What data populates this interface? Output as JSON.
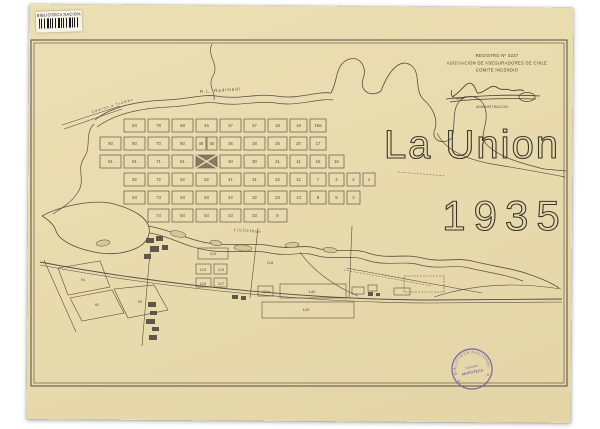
{
  "library_label": {
    "text": "BIBLIOTECA NACIONAL"
  },
  "registro": {
    "line1": "REGISTRO Nº 3237",
    "line2": "ASOCIACION DE ASEGURADORES DE CHILE",
    "line3": "COMITE INCENDIO",
    "signature_caption": "ADMINISTRACION"
  },
  "title": {
    "name": "La Union",
    "year": "1935"
  },
  "round_stamp": {
    "arc_text": "BIBLIOTECA NACIONAL",
    "center1": "Sección",
    "center2": "MAPOTECA",
    "star": "★",
    "color": "#6d52a3"
  },
  "map": {
    "ink": "#5a4f40",
    "sheet": "#e8dbae",
    "dark_fill": "#5f574a",
    "island_fill": "#d5c796",
    "plaza_fill": "#877b66",
    "labels": [
      {
        "t": "R.L. Radimadi",
        "x": 200,
        "y": 93,
        "r": -4,
        "s": 4.4
      },
      {
        "t": "Llollelhue",
        "x": 234,
        "y": 231,
        "r": 4,
        "s": 4.2
      },
      {
        "t": "Camino a Trumao",
        "x": 92,
        "y": 113,
        "r": -17,
        "s": 3.6
      }
    ],
    "grid": {
      "cols": [
        [
          100,
          21
        ],
        [
          124,
          21
        ],
        [
          148,
          21
        ],
        [
          172,
          21
        ],
        [
          196,
          21
        ],
        [
          220,
          21
        ],
        [
          244,
          21
        ],
        [
          268,
          19
        ],
        [
          290,
          17
        ],
        [
          310,
          16
        ],
        [
          329,
          15
        ],
        [
          347,
          13
        ],
        [
          363,
          12
        ]
      ],
      "rows": [
        {
          "y": 119,
          "h": 13,
          "cells": [
            {
              "c": 1,
              "n": "84"
            },
            {
              "c": 2,
              "n": "79"
            },
            {
              "c": 3,
              "n": "58"
            },
            {
              "c": 4,
              "n": "46"
            },
            {
              "c": 5,
              "n": "37"
            },
            {
              "c": 6,
              "n": "27"
            },
            {
              "c": 7,
              "n": "18"
            },
            {
              "c": 8,
              "n": "19"
            },
            {
              "c": 9,
              "n": "19a"
            }
          ]
        },
        {
          "y": 137,
          "h": 13,
          "cells": [
            {
              "c": 0,
              "n": "90"
            },
            {
              "c": 1,
              "n": "80"
            },
            {
              "c": 2,
              "n": "70"
            },
            {
              "c": 3,
              "n": "60"
            },
            {
              "x": 196,
              "w": 10,
              "n": "49"
            },
            {
              "x": 207,
              "w": 10,
              "n": "50"
            },
            {
              "c": 5,
              "n": "36"
            },
            {
              "c": 6,
              "n": "28"
            },
            {
              "c": 7,
              "n": "26"
            },
            {
              "c": 8,
              "n": "20"
            },
            {
              "c": 9,
              "n": "17"
            }
          ]
        },
        {
          "y": 155,
          "h": 13,
          "cells": [
            {
              "c": 0,
              "n": "91"
            },
            {
              "c": 1,
              "n": "81"
            },
            {
              "c": 2,
              "n": "71"
            },
            {
              "c": 3,
              "n": "61"
            },
            {
              "c": 4,
              "n": "PLAZA"
            },
            {
              "c": 5,
              "n": "40"
            },
            {
              "c": 6,
              "n": "30"
            },
            {
              "c": 7,
              "n": "21"
            },
            {
              "c": 8,
              "n": "11"
            },
            {
              "c": 9,
              "n": "16"
            },
            {
              "c": 10,
              "n": "15"
            }
          ]
        },
        {
          "y": 173,
          "h": 13,
          "cells": [
            {
              "c": 1,
              "n": "82"
            },
            {
              "c": 2,
              "n": "72"
            },
            {
              "c": 3,
              "n": "62"
            },
            {
              "c": 4,
              "n": "52"
            },
            {
              "c": 5,
              "n": "41"
            },
            {
              "c": 6,
              "n": "31"
            },
            {
              "c": 7,
              "n": "22"
            },
            {
              "c": 8,
              "n": "12"
            },
            {
              "c": 9,
              "n": "7"
            },
            {
              "c": 10,
              "n": "4"
            },
            {
              "c": 11,
              "n": "2"
            },
            {
              "c": 12,
              "n": "1"
            }
          ]
        },
        {
          "y": 191,
          "h": 13,
          "cells": [
            {
              "c": 1,
              "n": "83"
            },
            {
              "c": 2,
              "n": "73"
            },
            {
              "c": 3,
              "n": "63"
            },
            {
              "c": 4,
              "n": "53"
            },
            {
              "c": 5,
              "n": "42"
            },
            {
              "c": 6,
              "n": "32"
            },
            {
              "c": 7,
              "n": "23"
            },
            {
              "c": 8,
              "n": "13"
            },
            {
              "c": 9,
              "n": "8"
            },
            {
              "c": 10,
              "n": "5"
            },
            {
              "c": 11,
              "n": "3"
            }
          ]
        },
        {
          "y": 209,
          "h": 13,
          "cells": [
            {
              "c": 2,
              "n": "74"
            },
            {
              "c": 3,
              "n": "64"
            },
            {
              "c": 4,
              "n": "54"
            },
            {
              "c": 5,
              "n": "43"
            },
            {
              "c": 6,
              "n": "33"
            },
            {
              "c": 7,
              "n": "9"
            }
          ]
        }
      ]
    },
    "fields": [
      {
        "n": "91",
        "x": 83,
        "y": 281,
        "poly": "58,268 100,261 110,287 68,295"
      },
      {
        "n": "92",
        "x": 97,
        "y": 306,
        "poly": "70,298 112,290 124,313 82,321"
      },
      {
        "n": "93",
        "x": 140,
        "y": 303,
        "poly": "114,289 154,285 168,310 128,318"
      },
      {
        "n": "114",
        "x": 213,
        "y": 255
      },
      {
        "n": "113",
        "x": 203,
        "y": 271
      },
      {
        "n": "115",
        "x": 221,
        "y": 271
      },
      {
        "n": "116",
        "x": 203,
        "y": 285
      },
      {
        "n": "117",
        "x": 221,
        "y": 285
      },
      {
        "n": "118",
        "x": 270,
        "y": 264
      },
      {
        "n": "119a",
        "x": 266,
        "y": 293
      },
      {
        "n": "140",
        "x": 312,
        "y": 293
      },
      {
        "n": "120",
        "x": 306,
        "y": 311
      }
    ],
    "paths": [
      {
        "name": "rio-radimadi-north-bank",
        "d": "M 95 120 C 112 106 140 101 166 100 C 190 99 202 94 216 96 C 240 100 256 93 276 96 C 298 100 316 91 331 93 C 338 81 335 66 347 60 C 359 54 368 67 363 79 C 359 91 371 98 381 91 C 390 67 402 58 412 66 C 421 74 414 91 424 100 C 433 108 438 119 435 129 C 430 140 443 146 452 138 C 456 124 451 108 461 100 C 471 92 484 98 486 112 C 488 126 478 136 487 145 C 499 157 520 163 544 169 L 566 171",
        "w": 0.8
      },
      {
        "name": "rio-radimadi-south-bank",
        "d": "M 97 127 C 116 113 144 108 169 107 C 192 106 203 101 217 103 C 240 107 257 100 276 103 C 297 107 317 98 333 100",
        "w": 0.7
      },
      {
        "name": "rio-radimadi-outlet",
        "d": "M 437 133 C 446 152 470 160 492 164 C 516 168 540 172 565 177",
        "w": 0.7
      },
      {
        "name": "creek-north",
        "d": "M 212 44 C 206 56 220 64 213 76 C 207 86 216 92 214 100",
        "w": 0.7
      },
      {
        "name": "creek-west",
        "d": "M 94 124 C 84 134 92 146 84 158 C 76 170 86 180 78 192 C 72 202 62 208 53 214",
        "w": 0.7
      },
      {
        "name": "oxbow-lagoon",
        "d": "M 42 216 C 62 205 96 199 114 204 C 136 210 152 220 149 234 C 146 250 118 257 94 252 C 74 248 59 240 56 231 C 54 224 47 219 42 216",
        "w": 0.8
      },
      {
        "name": "rio-llollelhue-north-bank",
        "d": "M 148 226 C 172 230 188 240 208 243 C 232 247 252 242 272 246 C 292 250 302 244 316 248 C 336 254 352 247 368 253 C 388 260 404 253 422 258 C 442 263 456 257 472 261 C 496 267 512 268 528 274 C 543 279 552 283 559 288",
        "w": 0.8
      },
      {
        "name": "rio-llollelhue-south-bank",
        "d": "M 150 233 C 172 237 186 247 206 250 C 230 254 252 249 270 253 C 290 257 302 251 314 255 C 334 261 352 254 366 260 C 386 267 404 260 420 265 C 440 270 455 264 469 268 C 491 273 507 275 523 281",
        "w": 0.7
      },
      {
        "name": "railway-line-1",
        "d": "M 40 262 C 130 279 230 291 330 297 C 370 299 404 300 432 300 L 562 299",
        "w": 0.9
      },
      {
        "name": "railway-line-2",
        "d": "M 40 265 C 130 282 230 294 330 300 C 368 302 404 303 430 303 L 562 302",
        "w": 0.6
      },
      {
        "name": "road-trumao-1",
        "d": "M 62 125 L 120 106",
        "w": 0.6
      },
      {
        "name": "road-trumao-2",
        "d": "M 64 129 L 122 109",
        "w": 0.6
      },
      {
        "name": "street-south-1",
        "d": "M 258 228 L 250 298",
        "w": 0.6
      },
      {
        "name": "street-south-2",
        "d": "M 352 226 L 349 298",
        "w": 0.6
      },
      {
        "name": "channel-diagonal",
        "d": "M 300 252 C 312 270 334 286 358 296",
        "w": 0.6
      },
      {
        "name": "road-east-1",
        "d": "M 346 268 L 482 293",
        "w": 0.6
      },
      {
        "name": "road-east-2",
        "d": "M 434 297 C 458 289 484 285 512 285 C 530 285 548 287 561 289",
        "w": 0.6
      },
      {
        "name": "field-line-1",
        "d": "M 44 260 L 76 332",
        "w": 0.6
      },
      {
        "name": "field-line-2",
        "d": "M 150 252 L 142 346",
        "w": 0.6
      },
      {
        "name": "micro-text-railway",
        "d": "M 344 270 L 432 286",
        "w": 0.5,
        "dash": "1.6 1.6"
      },
      {
        "name": "micro-text-river",
        "d": "M 398 172 L 446 176",
        "w": 0.5,
        "dash": "1.6 1.6"
      }
    ],
    "islands": [
      [
        178,
        234,
        8,
        3,
        12
      ],
      [
        216,
        243,
        6,
        2.5,
        8
      ],
      [
        243,
        248,
        9,
        3,
        5
      ],
      [
        292,
        245,
        7,
        2.5,
        -4
      ],
      [
        330,
        250,
        7,
        2.5,
        6
      ],
      [
        103,
        243,
        7,
        3,
        -8
      ]
    ],
    "outline_rects": [
      [
        352,
        287,
        12,
        7
      ],
      [
        368,
        285,
        9,
        6
      ],
      [
        394,
        288,
        16,
        7
      ],
      [
        198,
        248,
        30,
        11
      ],
      [
        196,
        264,
        15,
        10
      ],
      [
        214,
        264,
        13,
        10
      ],
      [
        196,
        278,
        15,
        9
      ],
      [
        214,
        278,
        13,
        9
      ],
      [
        258,
        286,
        15,
        10
      ],
      [
        280,
        284,
        66,
        14
      ],
      [
        262,
        302,
        92,
        16
      ],
      [
        404,
        276,
        40,
        16,
        1
      ]
    ],
    "dark_rects": [
      [
        146,
        238,
        8,
        5
      ],
      [
        156,
        236,
        7,
        5
      ],
      [
        150,
        246,
        9,
        6
      ],
      [
        162,
        245,
        6,
        5
      ],
      [
        144,
        254,
        7,
        5
      ],
      [
        148,
        302,
        8,
        5
      ],
      [
        150,
        311,
        7,
        4
      ],
      [
        146,
        319,
        9,
        5
      ],
      [
        152,
        327,
        7,
        4
      ],
      [
        149,
        335,
        8,
        5
      ],
      [
        368,
        292,
        5,
        4
      ],
      [
        376,
        293,
        4,
        3
      ],
      [
        232,
        295,
        6,
        4
      ],
      [
        241,
        296,
        5,
        4
      ]
    ]
  }
}
